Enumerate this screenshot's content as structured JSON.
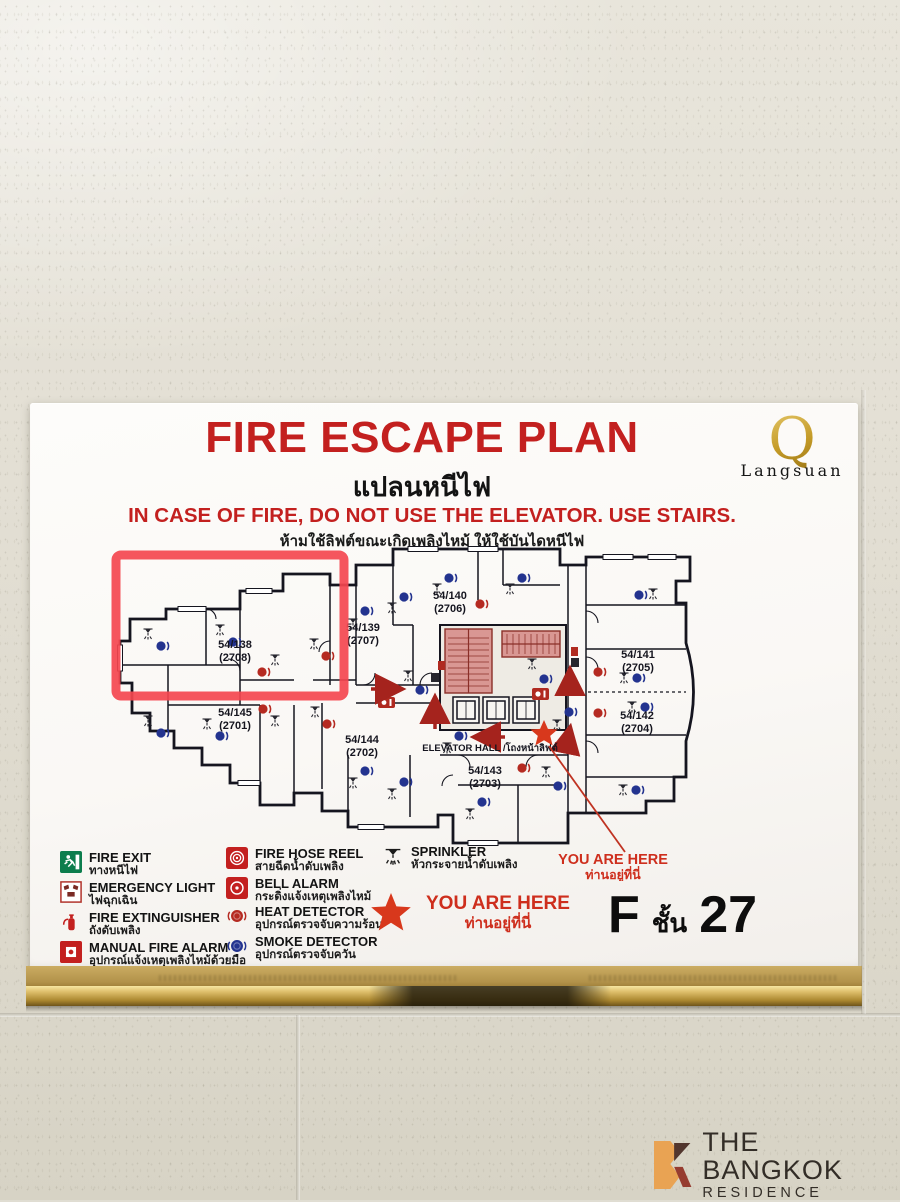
{
  "sign": {
    "title": "FIRE ESCAPE PLAN",
    "title_thai": "แปลนหนีไฟ",
    "warning": "IN CASE OF FIRE, DO NOT USE THE ELEVATOR. USE STAIRS.",
    "warning_thai": "ห้ามใช้ลิฟต์ขณะเกิดเพลิงไหม้ ให้ใช้บันไดหนีไฟ",
    "brand": {
      "initial": "Q",
      "name": "Langsuan"
    },
    "floor": {
      "letter": "F",
      "thai": "ชั้น",
      "number": "27"
    }
  },
  "plan": {
    "units": [
      {
        "unit": "54/138",
        "room": "(2708)"
      },
      {
        "unit": "54/145",
        "room": "(2701)"
      },
      {
        "unit": "54/139",
        "room": "(2707)"
      },
      {
        "unit": "54/144",
        "room": "(2702)"
      },
      {
        "unit": "54/140",
        "room": "(2706)"
      },
      {
        "unit": "54/143",
        "room": "(2703)"
      },
      {
        "unit": "54/141",
        "room": "(2705)"
      },
      {
        "unit": "54/142",
        "room": "(2704)"
      }
    ],
    "elevator_hall": "ELEVATOR HALL /โถงหน้าลิฟต์",
    "you_are_here": {
      "en": "YOU ARE HERE",
      "thai": "ท่านอยู่ที่นี่"
    }
  },
  "legend": {
    "items": [
      {
        "label": "FIRE EXIT",
        "thai": "ทางหนีไฟ"
      },
      {
        "label": "EMERGENCY LIGHT",
        "thai": "ไฟฉุกเฉิน"
      },
      {
        "label": "FIRE EXTINGUISHER",
        "thai": "ถังดับเพลิง"
      },
      {
        "label": "MANUAL FIRE ALARM",
        "thai": "อุปกรณ์แจ้งเหตุเพลิงไหม้ด้วยมือ"
      },
      {
        "label": "FIRE HOSE REEL",
        "thai": "สายฉีดน้ำดับเพลิง"
      },
      {
        "label": "BELL ALARM",
        "thai": "กระดิ่งแจ้งเหตุเพลิงไหม้"
      },
      {
        "label": "HEAT DETECTOR",
        "thai": "อุปกรณ์ตรวจจับความร้อน"
      },
      {
        "label": "SMOKE DETECTOR",
        "thai": "อุปกรณ์ตรวจจับควัน"
      },
      {
        "label": "SPRINKLER",
        "thai": "หัวกระจายน้ำดับเพลิง"
      }
    ],
    "you_are_here": {
      "en": "YOU ARE HERE",
      "thai": "ท่านอยู่ที่นี่"
    }
  },
  "watermark": {
    "line1": "THE BANGKOK",
    "line2": "RESIDENCE"
  },
  "colors": {
    "accent_red": "#c3201f",
    "highlight_box": "#f4474f",
    "star": "#d8381c",
    "smoke_blue": "#23338f",
    "heat_red": "#b52a21",
    "stair_pink": "#d99793",
    "gold": "#c9a441"
  }
}
